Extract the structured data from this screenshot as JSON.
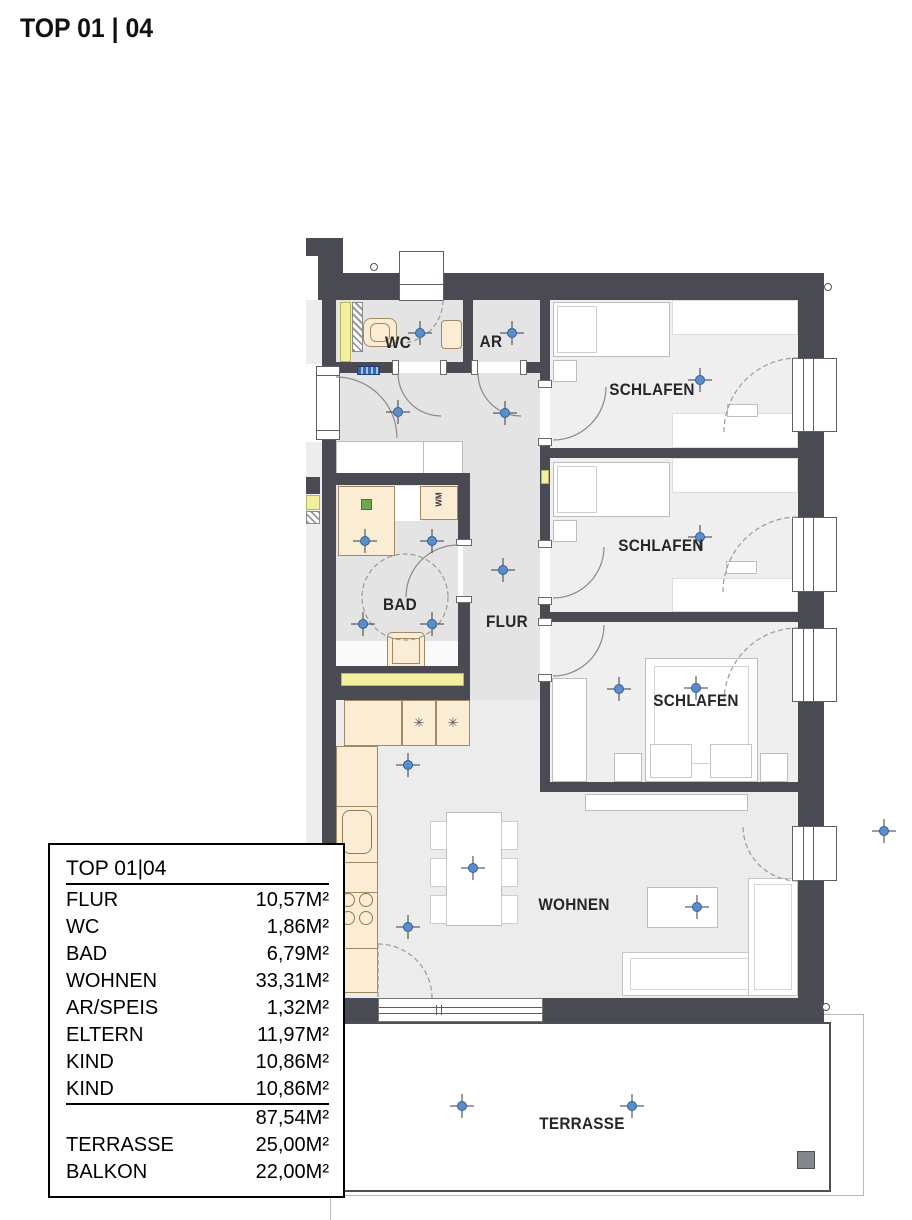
{
  "title": "TOP 01 | 04",
  "rooms": {
    "wc": "WC",
    "ar": "AR",
    "schlafen1": "SCHLAFEN",
    "schlafen2": "SCHLAFEN",
    "schlafen3": "SCHLAFEN",
    "bad": "BAD",
    "flur": "FLUR",
    "wohnen": "WOHNEN",
    "terrasse": "TERRASSE",
    "wm": "WM"
  },
  "kitchen": {
    "appliance_symbol": "✳"
  },
  "legend": {
    "title": "TOP 01|04",
    "rows": [
      {
        "label": "FLUR",
        "value": "10,57M²"
      },
      {
        "label": "WC",
        "value": "1,86M²"
      },
      {
        "label": "BAD",
        "value": "6,79M²"
      },
      {
        "label": "WOHNEN",
        "value": "33,31M²"
      },
      {
        "label": "AR/SPEIS",
        "value": "1,32M²"
      },
      {
        "label": "ELTERN",
        "value": "11,97M²"
      },
      {
        "label": "KIND",
        "value": "10,86M²"
      },
      {
        "label": "KIND",
        "value": "10,86M²"
      },
      {
        "label": "",
        "value": "87,54M²"
      },
      {
        "label": "TERRASSE",
        "value": "25,00M²"
      },
      {
        "label": "BALKON",
        "value": "22,00M²"
      }
    ]
  },
  "colors": {
    "wall": "#4a4a53",
    "floorService": "#e4e4e4",
    "floorBedroom": "#efefef",
    "floorLiving": "#ececec",
    "beige": "#fbecd4",
    "beigeb": "#a08a66",
    "yellow": "#f2f09e",
    "blue": "#5b8ec9",
    "green": "#6aa84f",
    "panel": "#3a66b0"
  }
}
